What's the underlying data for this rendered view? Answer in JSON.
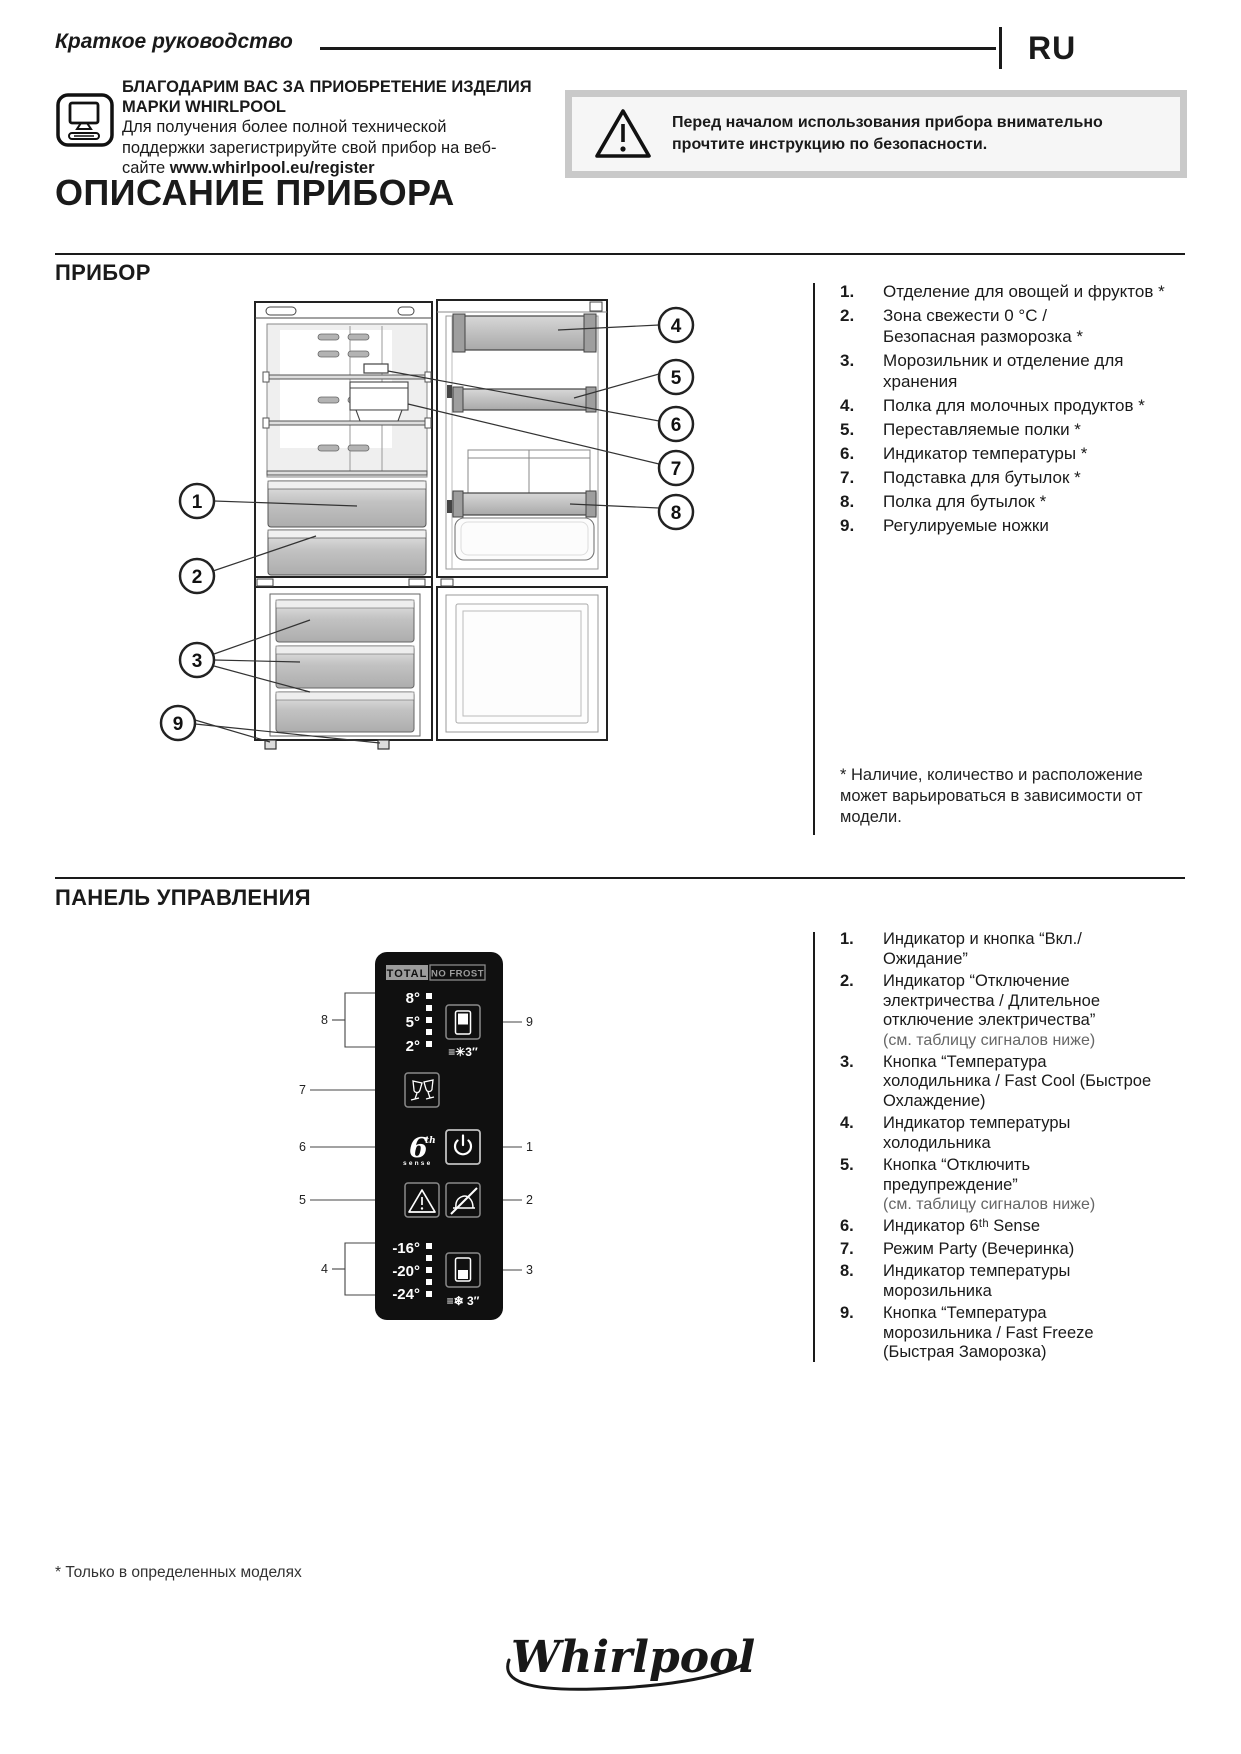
{
  "header": {
    "doc_title": "Краткое руководство",
    "lang_code": "RU"
  },
  "intro": {
    "thanks_bold": "БЛАГОДАРИМ ВАС ЗА ПРИОБРЕТЕНИЕ ИЗДЕЛИЯ\nМАРКИ WHIRLPOOL",
    "support_line1": "Для получения более полной технической",
    "support_line2": "поддержки зарегистрируйте свой прибор на веб-",
    "support_line3_prefix": "сайте ",
    "support_url": "www.whirlpool.eu/register",
    "warning_text": "Перед началом использования прибора внимательно\nпрочтите инструкцию по безопасности."
  },
  "page_title": "ОПИСАНИЕ ПРИБОРА",
  "appliance": {
    "heading": "ПРИБОР",
    "items": [
      {
        "num": "1.",
        "text": "Отделение для овощей и фруктов *"
      },
      {
        "num": "2.",
        "text": "Зона свежести 0 °C /\nБезопасная разморозка *"
      },
      {
        "num": "3.",
        "text": "Морозильник и отделение для\nхранения"
      },
      {
        "num": "4.",
        "text": "Полка для молочных продуктов *"
      },
      {
        "num": "5.",
        "text": "Переставляемые полки *"
      },
      {
        "num": "6.",
        "text": "Индикатор температуры *"
      },
      {
        "num": "7.",
        "text": "Подставка для бутылок *"
      },
      {
        "num": "8.",
        "text": "Полка для бутылок *"
      },
      {
        "num": "9.",
        "text": "Регулируемые ножки"
      }
    ],
    "callouts": [
      "1",
      "2",
      "3",
      "4",
      "5",
      "6",
      "7",
      "8",
      "9"
    ],
    "footnote": "* Наличие, количество и расположение\nможет варьироваться в зависимости от\nмодели."
  },
  "panel": {
    "heading": "ПАНЕЛЬ УПРАВЛЕНИЯ",
    "items": [
      {
        "num": "1.",
        "text": "Индикатор и кнопка “Вкл./\nОжидание”"
      },
      {
        "num": "2.",
        "text": "Индикатор “Отключение\nэлектричества / Длительное\nотключение электричества”",
        "note": "(см. таблицу сигналов ниже)"
      },
      {
        "num": "3.",
        "text": "Кнопка “Температура\nхолодильника / Fast Cool (Быстрое\nОхлаждение)"
      },
      {
        "num": "4.",
        "text": "Индикатор температуры\nхолодильника"
      },
      {
        "num": "5.",
        "text": "Кнопка “Отключить\nпредупреждение”",
        "note": "(см. таблицу сигналов ниже)"
      },
      {
        "num": "6.",
        "text": "Индикатор 6ᵗʰ Sense"
      },
      {
        "num": "7.",
        "text": "Режим Party (Вечеринка)"
      },
      {
        "num": "8.",
        "text": "Индикатор температуры\nморозильника"
      },
      {
        "num": "9.",
        "text": "Кнопка “Температура\nморозильника / Fast Freeze\n(Быстрая Заморозка)"
      }
    ],
    "display": {
      "brand_left": "TOTAL",
      "brand_right": "NO FROST",
      "fridge_temps": [
        "8°",
        "5°",
        "2°"
      ],
      "freezer_temps": [
        "-16°",
        "-20°",
        "-24°"
      ],
      "fridge_hold": "≡✳3″",
      "freezer_hold": "≡❄ 3″",
      "sense_6": "6",
      "sense_th": "th",
      "sense_word": "sense",
      "callouts_left": [
        "8",
        "7",
        "6",
        "5",
        "4"
      ],
      "callouts_right": [
        "9",
        "1",
        "2",
        "3"
      ]
    }
  },
  "page_footnote": "* Только в определенных моделях",
  "brand_logo": "Whirlpool"
}
